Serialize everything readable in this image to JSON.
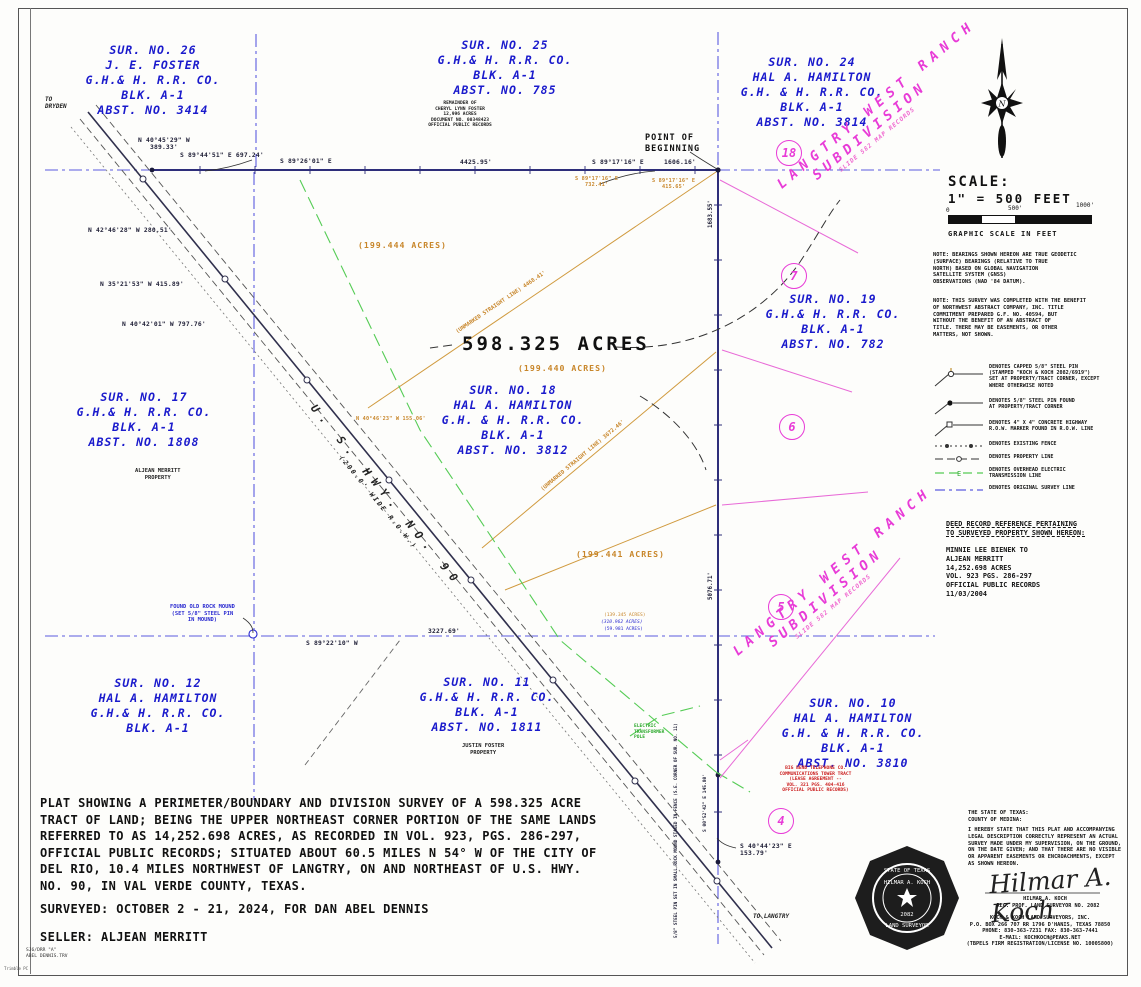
{
  "surveys": {
    "s26": {
      "l1": "SUR. NO. 26",
      "l2": "J. E. FOSTER",
      "l3": "G.H.& H. R.R. CO.",
      "l4": "BLK. A-1",
      "l5": "ABST. NO. 3414"
    },
    "s25": {
      "l1": "SUR. NO. 25",
      "l2": "G.H.& H. R.R. CO.",
      "l3": "BLK. A-1",
      "l4": "ABST. NO. 785"
    },
    "s24": {
      "l1": "SUR. NO. 24",
      "l2": "HAL A. HAMILTON",
      "l3": "G.H. & H. R.R. CO.",
      "l4": "BLK. A-1",
      "l5": "ABST. NO. 3814"
    },
    "s19": {
      "l1": "SUR. NO. 19",
      "l2": "G.H.& H. R.R. CO.",
      "l3": "BLK. A-1",
      "l4": "ABST. NO. 782"
    },
    "s18": {
      "l1": "SUR. NO. 18",
      "l2": "HAL A. HAMILTON",
      "l3": "G.H. & H. R.R. CO.",
      "l4": "BLK. A-1",
      "l5": "ABST. NO. 3812"
    },
    "s17": {
      "l1": "SUR. NO. 17",
      "l2": "G.H.& H. R.R. CO.",
      "l3": "BLK. A-1",
      "l4": "ABST. NO. 1808"
    },
    "s12": {
      "l1": "SUR. NO. 12",
      "l2": "HAL A. HAMILTON",
      "l3": "G.H.& H. R.R. CO.",
      "l4": "BLK. A-1"
    },
    "s11": {
      "l1": "SUR. NO. 11",
      "l2": "G.H.& H. R.R. CO.",
      "l3": "BLK. A-1",
      "l4": "ABST. NO. 1811"
    },
    "s10": {
      "l1": "SUR. NO. 10",
      "l2": "HAL A. HAMILTON",
      "l3": "G.H. & H. R.R. CO.",
      "l4": "BLK. A-1",
      "l5": "ABST. NO. 3810"
    }
  },
  "areas": {
    "total": "598.325  ACRES",
    "a1": "(199.444  ACRES)",
    "a2": "(199.440  ACRES)",
    "a3": "(199.441  ACRES)",
    "small1": "(139.345 ACRES)",
    "small2": "(310.962 ACRES)",
    "small3": "(59.981 ACRES)"
  },
  "poi": {
    "pob": "POINT OF\nBEGINNING",
    "to_dryden": "TO\nDRYDEN",
    "to_langtry": "TO LANGTRY",
    "rock_mound": "FOUND OLD ROCK MOUND\n(SET 5/8\" STEEL PIN\nIN MOUND)",
    "transformer": "ELECTRIC\nTRANSFORMER\nPOLE",
    "aljean": "ALJEAN MERRITT\nPROPERTY",
    "justin": "JUSTIN FOSTER\nPROPERTY",
    "remainder": "REMAINDER OF\nCHERYL LYNN FOSTER\n12,996 ACRES\nDOCUMENT NO. 00348423\nOFFICIAL PUBLIC RECORDS",
    "bigbend": "BIG BEND TELEPHONE CO.\nCOMMUNICATIONS TOWER TRACT\n(LEASE AGREEMENT --\nVOL. 321  PGS. 404-416\nOFFICIAL PUBLIC RECORDS)",
    "pin_note": "5/8\" STEEL PIN SET IN SMALL ROCK MOUND STAKED IN FENCE (S.E. CORNER OF SUR. NO. 11)"
  },
  "hwy": {
    "name": "U.  S.  HWY.  NO.  90",
    "row": "(200.0'  WIDE  R.O.W.)"
  },
  "subdivision": {
    "name1": "LANGTRY   WEST   RANCH",
    "name2": "SUBDIVISION",
    "records": "SLIDE 582  MAP RECORDS",
    "lot18": "18",
    "lot7": "7",
    "lot6": "6",
    "lot5": "5",
    "lot4": "4"
  },
  "bearings": {
    "b1": "N 40°45'29\" W\n389.33'",
    "b2": "S 89°44'51\" E 697.24'",
    "b3": "S 89°26'01\" E",
    "b4": "4425.95'",
    "b5": "S 89°17'16\" E",
    "b6": "1606.16'",
    "b7": "S 89°17'16\" E\n732.41'",
    "b8": "S 89°17'16\" E\n415.65'",
    "b9": "N 42°46'28\" W 280.51'",
    "b10": "N 35°21'53\" W 415.89'",
    "b11": "N 40°42'01\" W 797.76'",
    "b12": "N 40°46'23\" W 155.06'",
    "b13": "S 89°22'10\" W",
    "b14": "3227.69'",
    "b15": "S 40°44'23\" E\n153.79'",
    "b16": "1683.55'",
    "b17": "5076.71'",
    "b18": "S 00°52'42\" E  145.80'",
    "line1": "(UNMARKED STRAIGHT LINE)   4468.41'",
    "line2": "(UNMARKED STRAIGHT LINE)   3672.46'"
  },
  "scalebar": {
    "title": "SCALE:",
    "ratio": "1\" = 500 FEET",
    "t0": "0",
    "t500": "500'",
    "t1000": "1000'",
    "caption": "GRAPHIC SCALE IN FEET"
  },
  "notes": {
    "note1": "NOTE: BEARINGS SHOWN HEREON ARE TRUE GEODETIC\n(SURFACE) BEARINGS (RELATIVE TO TRUE\nNORTH) BASED ON GLOBAL NAVIGATION\nSATELLITE SYSTEM (GNSS)\nOBSERVATIONS (NAD '84 DATUM).",
    "note2": "NOTE: THIS SURVEY WAS COMPLETED WITH THE BENEFIT\nOF NORTHWEST ABSTRACT COMPANY, INC. TITLE\nCOMMITMENT PREPARED G.F. NO. 40594, BUT\nWITHOUT THE BENEFIT OF AN ABSTRACT OF\nTITLE.  THERE MAY BE EASEMENTS, OR OTHER\nMATTERS, NOT SHOWN."
  },
  "legend": {
    "items": [
      {
        "text": "DENOTES CAPPED 5/8\" STEEL PIN\n(STAMPED \"KOCH & KOCH 2082/6919\")\nSET AT PROPERTY/TRACT CORNER, EXCEPT\nWHERE OTHERWISE NOTED"
      },
      {
        "text": "DENOTES 5/8\" STEEL PIN FOUND\nAT PROPERTY/TRACT CORNER"
      },
      {
        "text": "DENOTES 4\" X 4\" CONCRETE HIGHWAY\nR.O.W. MARKER FOUND IN R.O.W. LINE"
      },
      {
        "text": "DENOTES EXISTING FENCE"
      },
      {
        "text": "DENOTES PROPERTY LINE"
      },
      {
        "text": "DENOTES OVERHEAD ELECTRIC\nTRANSMISSION LINE"
      },
      {
        "text": "DENOTES ORIGINAL SURVEY LINE"
      }
    ]
  },
  "deed": {
    "title": "DEED RECORD REFERENCE PERTAINING\nTO SURVEYED PROPERTY SHOWN HEREON:",
    "body": "MINNIE LEE BIENEK  TO\nALJEAN MERRITT\n14,252.698 ACRES\nVOL. 923  PGS. 286-297\nOFFICIAL PUBLIC RECORDS\n11/03/2004"
  },
  "description": {
    "plat": "PLAT SHOWING A PERIMETER/BOUNDARY AND DIVISION SURVEY OF A 598.325 ACRE\nTRACT OF LAND; BEING THE UPPER NORTHEAST CORNER PORTION OF THE SAME LANDS\nREFERRED TO AS 14,252.698 ACRES, AS RECORDED IN VOL. 923, PGS. 286-297,\nOFFICIAL PUBLIC RECORDS; SITUATED ABOUT 60.5 MILES N 54° W OF THE CITY OF\nDEL RIO, 10.4 MILES NORTHWEST OF LANGTRY, ON AND NORTHEAST OF U.S. HWY.\nNO. 90, IN VAL VERDE COUNTY, TEXAS.",
    "surveyed": "SURVEYED: OCTOBER 2 - 21, 2024, FOR DAN ABEL DENNIS",
    "seller": "SELLER: ALJEAN MERRITT"
  },
  "cert": {
    "state": "THE STATE OF TEXAS:\nCOUNTY OF MEDINA:",
    "body": "I HEREBY STATE THAT THIS PLAT AND ACCOMPANYING\nLEGAL DESCRIPTION CORRECTLY REPRESENT AN ACTUAL\nSURVEY MADE UNDER MY SUPERVISION, ON THE GROUND,\nON THE DATE GIVEN; AND THAT THERE ARE NO VISIBLE\nOR APPARENT EASEMENTS OR ENCROACHMENTS, EXCEPT\nAS SHOWN HEREON.",
    "signature": "Hilmar A. Koch",
    "name": "HILMAR A. KOCH",
    "reg": "REG. PROF. LAND SURVEYOR NO. 2082",
    "firm": "KOCH & KOCH LAND SURVEYORS, INC.\nP.O. BOX 266  707 RR 1796  D'HANIS, TEXAS 78850\nPHONE: 830-363-7231    FAX: 830-363-7441\nE-MAIL: KOCHKOCH@PEAKS.NET\n(TBPELS FIRM REGISTRATION/LICENSE NO. 10005800)",
    "seal_top": "STATE OF TEXAS",
    "seal_name": "HILMAR A. KOCH",
    "seal_num": "2082",
    "seal_bottom": "LAND SURVEYOR"
  },
  "footer": {
    "file1": "SJ6/DRR \"A\"",
    "file2": "ABEL DENNIS.TRV",
    "app": "Trimble PC"
  },
  "colors": {
    "blue": "#1a1acc",
    "orange": "#c8862a",
    "magenta": "#e83bd7",
    "green": "#2faa2f",
    "survey_blue": "#5b5bdf"
  }
}
